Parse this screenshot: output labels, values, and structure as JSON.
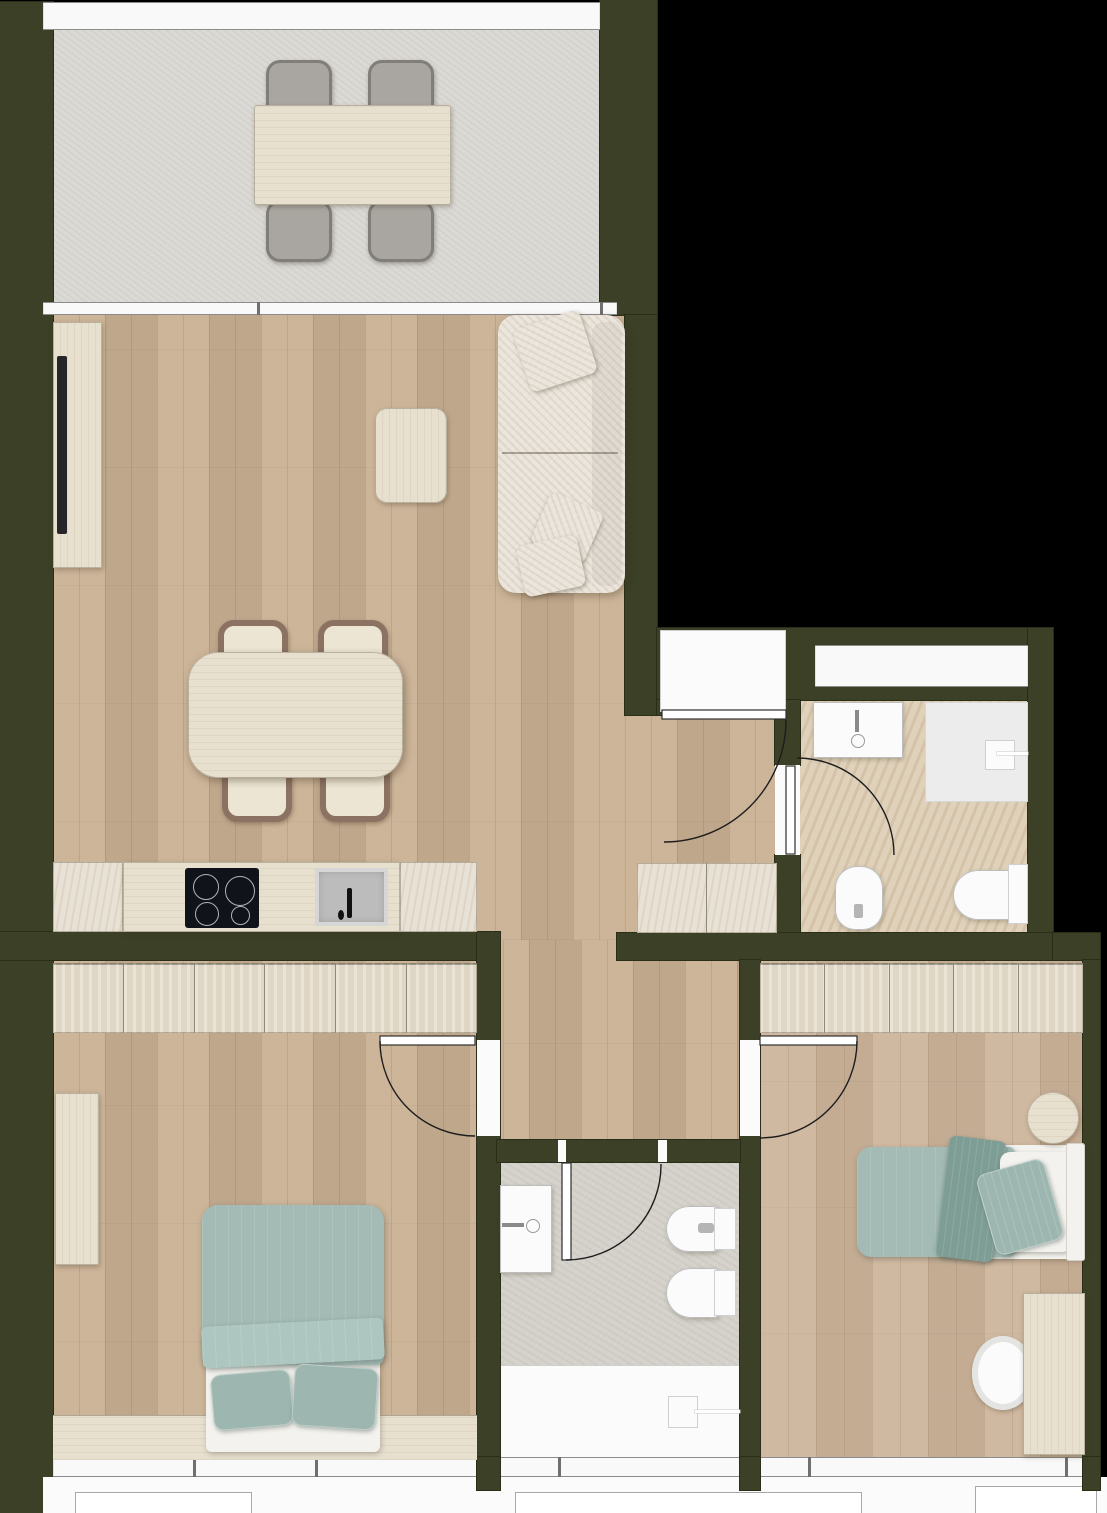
{
  "meta": {
    "type": "architectural-floor-plan",
    "view": "top-down-render",
    "visible_text_labels": []
  },
  "palette": {
    "bg": "#000000",
    "wall": "#3b4026",
    "wallEdge": "#2a2d18",
    "balconyFloor": "#dbd9d4",
    "woodLiving": "#c9b093",
    "woodBed2": "#cdb49a",
    "travertine": "#e6dfd1",
    "bath1Floor": "#dccdb4",
    "bath2Floor": "#d5d2cb",
    "glass": "#f9f9f9",
    "frame": "#8b8b8b",
    "fixtureWhite": "#fbfbfb",
    "fixtureOutline": "#bdbdbd",
    "tealDuvet": "#a3bbb4",
    "tealDeep": "#7e9d95",
    "tealPillow": "#9db7b0",
    "sheetWhite": "#f3f2ee",
    "sofaCream": "#eae4da",
    "chairGray": "#a9a5a0",
    "chairGrayDark": "#817d77",
    "chairBrown": "#8b7262",
    "chairSeat": "#ece5d3",
    "tableWood": "#e7e0cf",
    "hobBlack": "#10131a",
    "sinkGray": "#bcbcbc",
    "tvBlack": "#26262a"
  },
  "rooms": [
    {
      "name": "balcony",
      "floor": "concrete"
    },
    {
      "name": "living-dining-kitchen",
      "floor": "wood"
    },
    {
      "name": "entrance-hall",
      "floor": "wood"
    },
    {
      "name": "corridor",
      "floor": "wood"
    },
    {
      "name": "bathroom-1",
      "floor": "travertine"
    },
    {
      "name": "bathroom-2",
      "floor": "stone"
    },
    {
      "name": "bedroom-1",
      "floor": "wood"
    },
    {
      "name": "bedroom-2",
      "floor": "wood"
    },
    {
      "name": "entrance-landing",
      "floor": "white"
    }
  ],
  "furniture": {
    "balcony": [
      "outdoor-dining-table",
      "outdoor-chair x4"
    ],
    "living": [
      "tv-sideboard",
      "tv",
      "coffee-table",
      "sofa",
      "dining-table",
      "dining-chair x4"
    ],
    "kitchen": [
      "base-cabinet x2",
      "counter",
      "induction-hob",
      "kitchen-sink"
    ],
    "entrance-hall": [
      "hall-cabinet"
    ],
    "bathroom-1": [
      "washbasin",
      "shower",
      "bidet",
      "toilet",
      "window"
    ],
    "bathroom-2": [
      "washbasin",
      "shower",
      "bidet",
      "toilet"
    ],
    "bedroom-1": [
      "wardrobe-6-door",
      "tall-dresser",
      "double-bed-teal",
      "low-bench"
    ],
    "bedroom-2": [
      "wardrobe-5-door",
      "single-bed-teal",
      "round-side-table",
      "desk",
      "desk-chair"
    ]
  },
  "kitchen": {
    "hob_burners": 4
  },
  "closets": [
    {
      "target": "bedroom1-wardrobe",
      "doors": 6
    },
    {
      "target": "bedroom2-wardrobe",
      "doors": 5
    }
  ],
  "doors": [
    {
      "name": "entrance-door",
      "swing": "into-hall"
    },
    {
      "name": "bathroom-1-door",
      "swing": "into-bathroom"
    },
    {
      "name": "bedroom-1-door",
      "swing": "into-bedroom"
    },
    {
      "name": "bedroom-2-door",
      "swing": "into-bedroom"
    },
    {
      "name": "bathroom-2-door",
      "swing": "into-bathroom"
    }
  ],
  "windows": [
    {
      "name": "balcony-balustrade"
    },
    {
      "name": "living-balcony-sliding-door"
    },
    {
      "name": "bathroom-1-window"
    },
    {
      "name": "south-window-band"
    }
  ]
}
